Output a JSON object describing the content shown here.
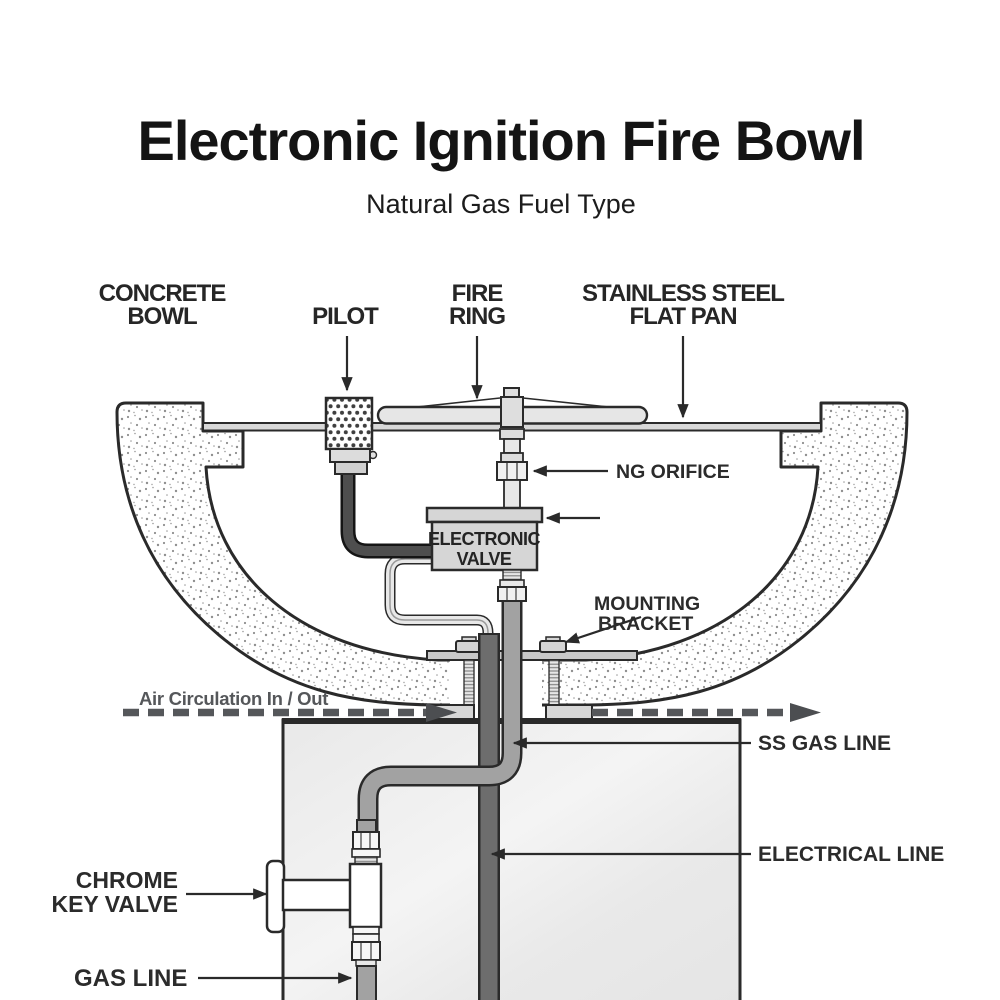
{
  "header": {
    "title": "Electronic Ignition Fire Bowl",
    "subtitle": "Natural Gas Fuel Type"
  },
  "diagram": {
    "labels": {
      "concrete_bowl": {
        "line1": "CONCRETE",
        "line2": "BOWL"
      },
      "pilot": {
        "text": "PILOT"
      },
      "fire_ring": {
        "line1": "FIRE",
        "line2": "RING"
      },
      "flat_pan": {
        "line1": "STAINLESS STEEL",
        "line2": "FLAT PAN"
      },
      "ng_orifice": {
        "text": "NG ORIFICE"
      },
      "electronic_valve": {
        "line1": "ELECTRONIC",
        "line2": "VALVE"
      },
      "mounting_bracket": {
        "line1": "MOUNTING",
        "line2": "BRACKET"
      },
      "air_circulation": {
        "text": "Air Circulation In / Out"
      },
      "ss_gas_line": {
        "text": "SS GAS LINE"
      },
      "electrical_line": {
        "text": "ELECTRICAL  LINE"
      },
      "chrome_key_valve": {
        "line1": "CHROME",
        "line2": "KEY VALVE"
      },
      "gas_line": {
        "text": "GAS LINE"
      }
    },
    "colors": {
      "ink": "#2a2a2a",
      "muted_gray_label": "#55575a",
      "ss_pipe_gray": "#a2a2a2",
      "electrical_conduit_gray": "#6d6d6d",
      "fitting_light_gray": "#d8d8d8",
      "pedestal_fill": "#ececec",
      "pilot_tube_dark": "#4e4e4e"
    }
  }
}
